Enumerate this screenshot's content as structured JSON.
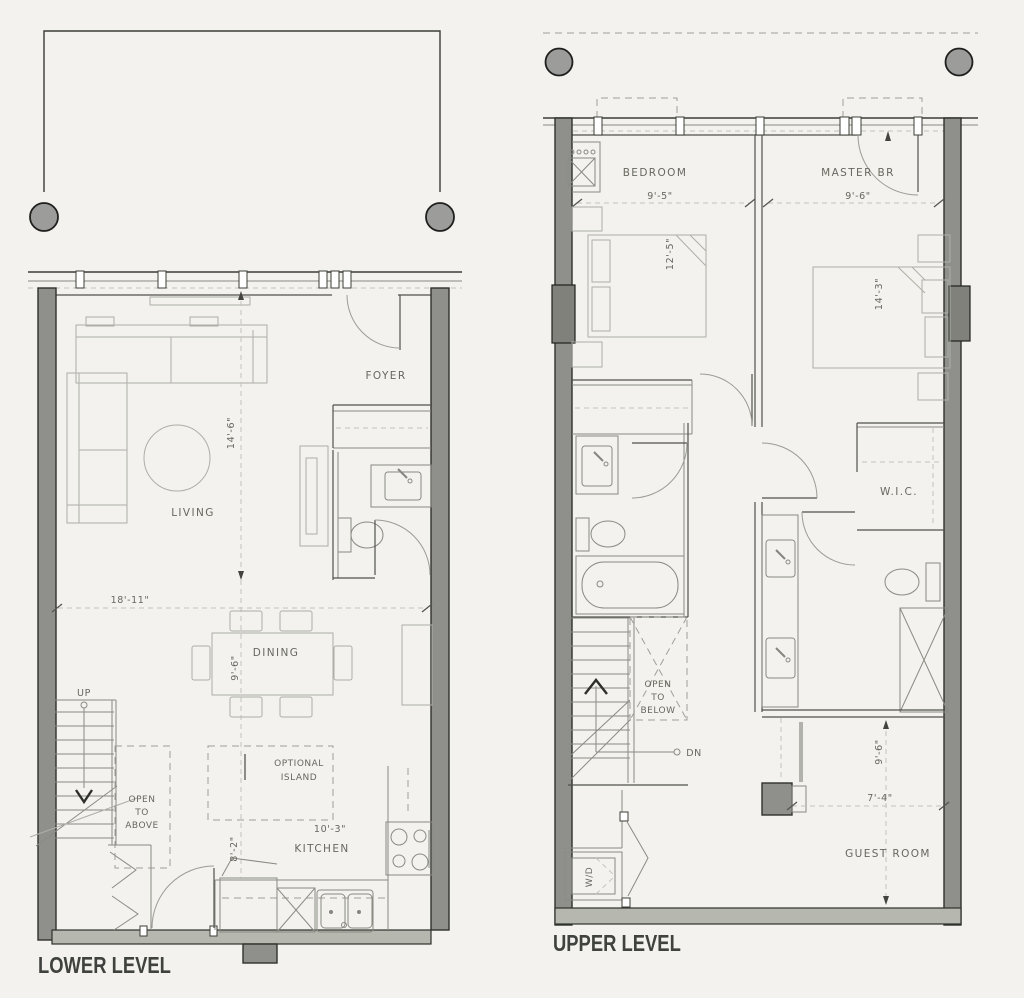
{
  "colors": {
    "background": "#f3f2ee",
    "wall": "#8f908c",
    "wall_light": "#b6b8b0",
    "line": "#51524c",
    "text": "#67685f",
    "title": "#3f423e"
  },
  "lower": {
    "title": "LOWER LEVEL",
    "rooms": {
      "living": "LIVING",
      "dining": "DINING",
      "kitchen": "KITCHEN",
      "foyer": "FOYER"
    },
    "stairs": {
      "up": "UP",
      "open_to_above": [
        "OPEN",
        "TO",
        "ABOVE"
      ]
    },
    "island": [
      "OPTIONAL",
      "ISLAND"
    ],
    "dims": {
      "living_width": "18'-11\"",
      "living_depth": "14'-6\"",
      "dining_depth": "9'-6\"",
      "kitchen_width": "10'-3\"",
      "kitchen_depth": "8'-2\""
    }
  },
  "upper": {
    "title": "UPPER LEVEL",
    "rooms": {
      "bedroom": "BEDROOM",
      "master": "MASTER BR",
      "wic": "W.I.C.",
      "guest": "GUEST ROOM"
    },
    "stairs": {
      "dn": "DN",
      "open_to_below": [
        "OPEN",
        "TO",
        "BELOW"
      ]
    },
    "laundry": "W/D",
    "dims": {
      "bedroom_width": "9'-5\"",
      "bedroom_depth": "12'-5\"",
      "master_width": "9'-6\"",
      "master_depth": "14'-3\"",
      "guest_depth": "9'-6\"",
      "guest_width": "7'-4\""
    }
  }
}
